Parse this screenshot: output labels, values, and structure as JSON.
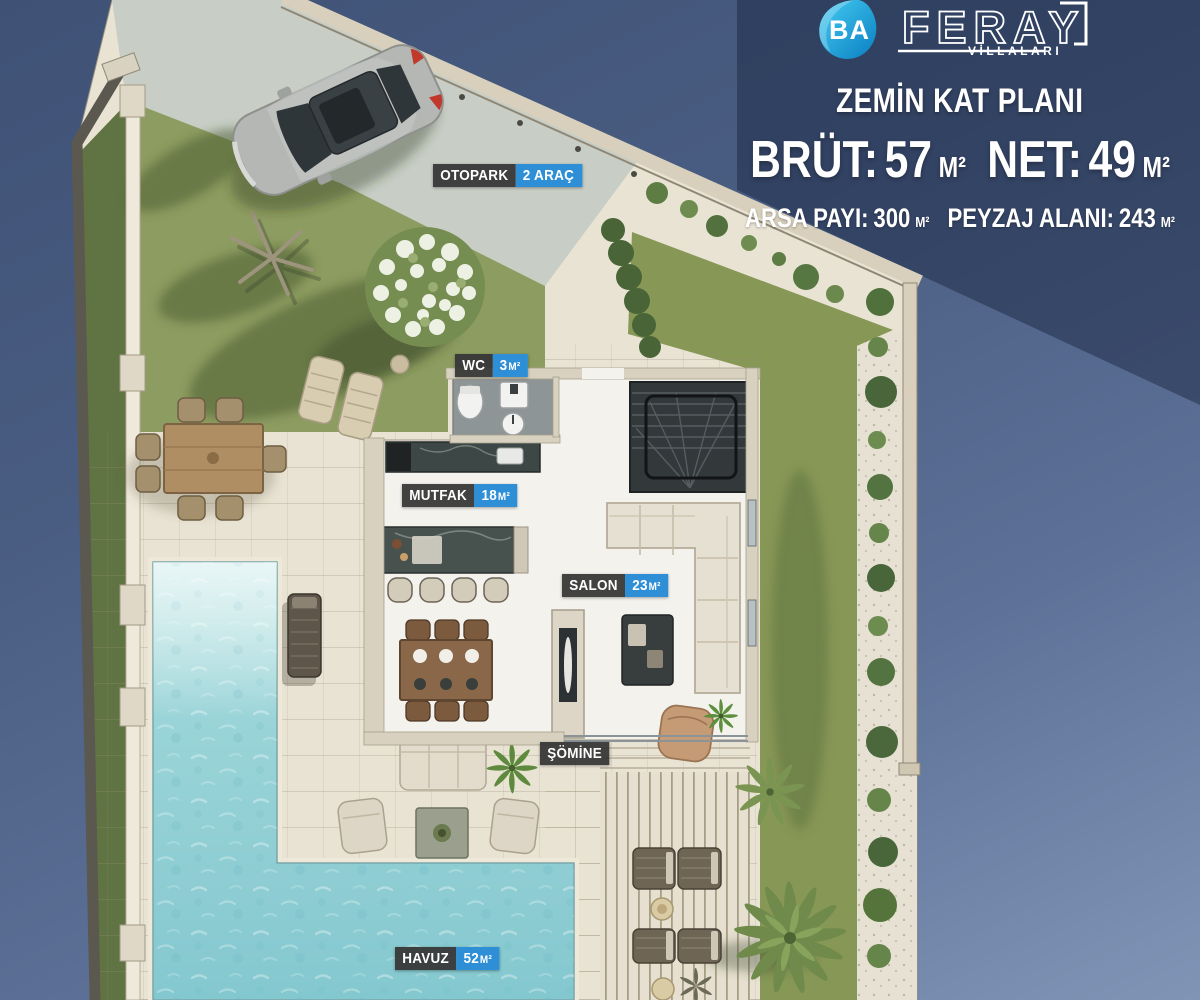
{
  "header": {
    "logo": {
      "ba": "BA",
      "name": "FERAY",
      "subtitle": "VİLLALARI"
    },
    "title": "ZEMİN KAT PLANI",
    "stats_primary": [
      {
        "label": "BRÜT:",
        "value": "57",
        "unit": "M²"
      },
      {
        "label": "NET:",
        "value": "49",
        "unit": "M²"
      }
    ],
    "stats_secondary": [
      {
        "label": "ARSA PAYI:",
        "value": "300",
        "unit": "M²"
      },
      {
        "label": "PEYZAJ ALANI:",
        "value": "243",
        "unit": "M²"
      }
    ]
  },
  "plan": {
    "labels": [
      {
        "id": "otopark",
        "name": "OTOPARK",
        "num": "2 ARAÇ",
        "unit": ""
      },
      {
        "id": "wc",
        "name": "WC",
        "num": "3",
        "unit": "M²"
      },
      {
        "id": "mutfak",
        "name": "MUTFAK",
        "num": "18",
        "unit": "M²"
      },
      {
        "id": "salon",
        "name": "SALON",
        "num": "23",
        "unit": "M²"
      },
      {
        "id": "somine",
        "name": "ŞÖMİNE",
        "num": "",
        "unit": ""
      },
      {
        "id": "havuz",
        "name": "HAVUZ",
        "num": "52",
        "unit": "M²"
      }
    ],
    "colors": {
      "label_dark": "#363636",
      "label_blue": "#2E8FD6",
      "logo_blue": "#1FA9E0"
    }
  }
}
